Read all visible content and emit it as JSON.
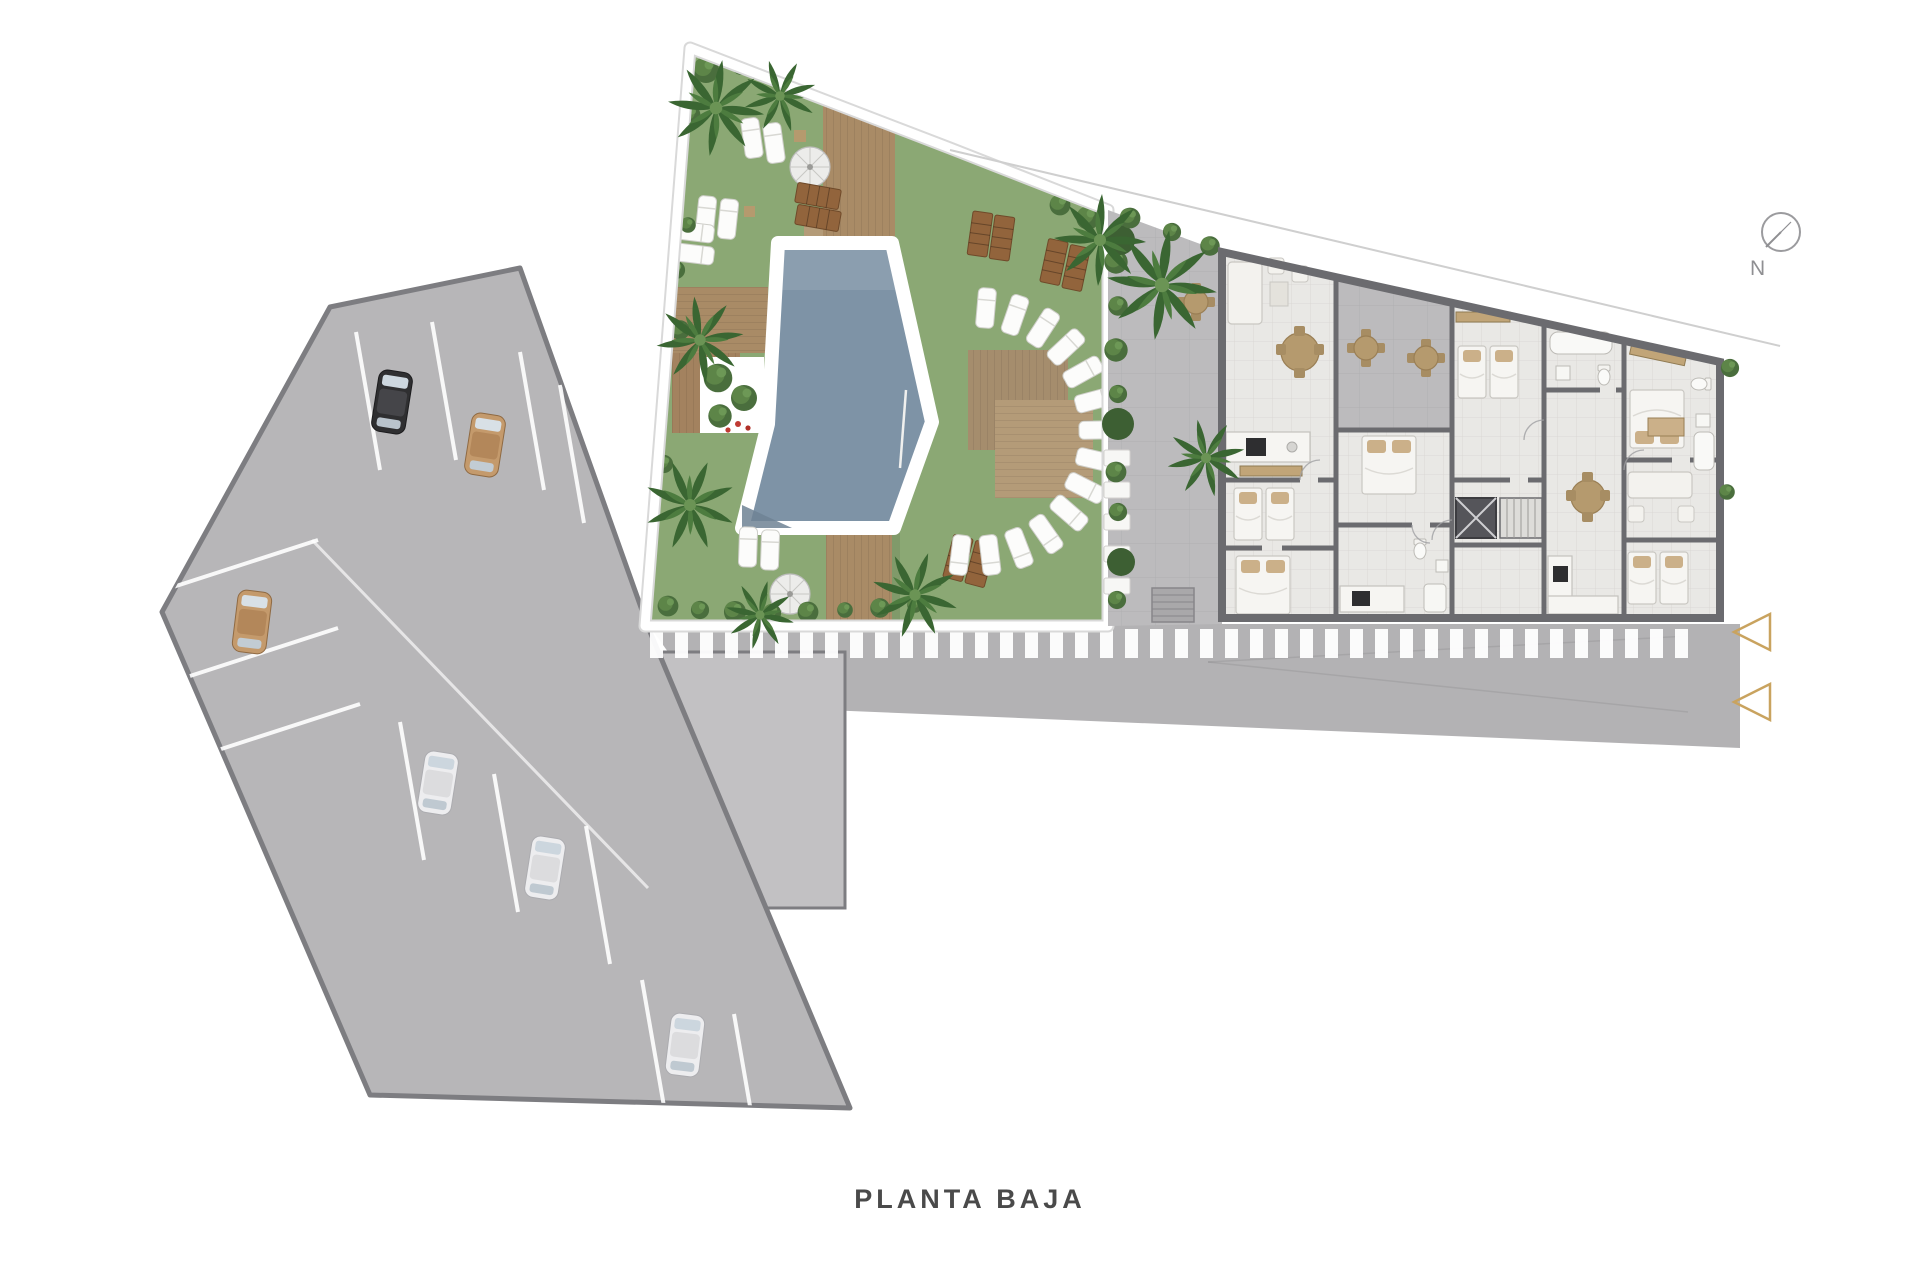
{
  "meta": {
    "title": "PLANTA BAJA"
  },
  "compass": {
    "label": "N"
  },
  "markers": {
    "entrance_arrow_count": 2
  },
  "parking": {
    "cars": [
      {
        "color_name": "black"
      },
      {
        "color_name": "tan"
      },
      {
        "color_name": "tan"
      },
      {
        "color_name": "white"
      },
      {
        "color_name": "white"
      },
      {
        "color_name": "white"
      }
    ]
  },
  "colors": {
    "grass": "#8BA874",
    "pool": "#7E93A6",
    "pool_rim": "#FFFFFF",
    "deck": "#A98B66",
    "deck_light": "#B49B78",
    "parking": "#B7B6B8",
    "parking_border": "#7D7D81",
    "road": "#B3B2B4",
    "stripe": "#FFFFFF",
    "wall": "#6B6B6F",
    "floor": "#E9E8E5",
    "terrace": "#BCBBBD",
    "hedge": "#4A6E3D",
    "palm": "#3A6632",
    "bench": "#92643C",
    "accent_gold": "#C9A35F",
    "car_black": "#2F2F31",
    "car_tan": "#C49A6C",
    "car_white": "#EDEDEF",
    "text": "#4A4A4A",
    "compass_gray": "#9B9B9E"
  }
}
